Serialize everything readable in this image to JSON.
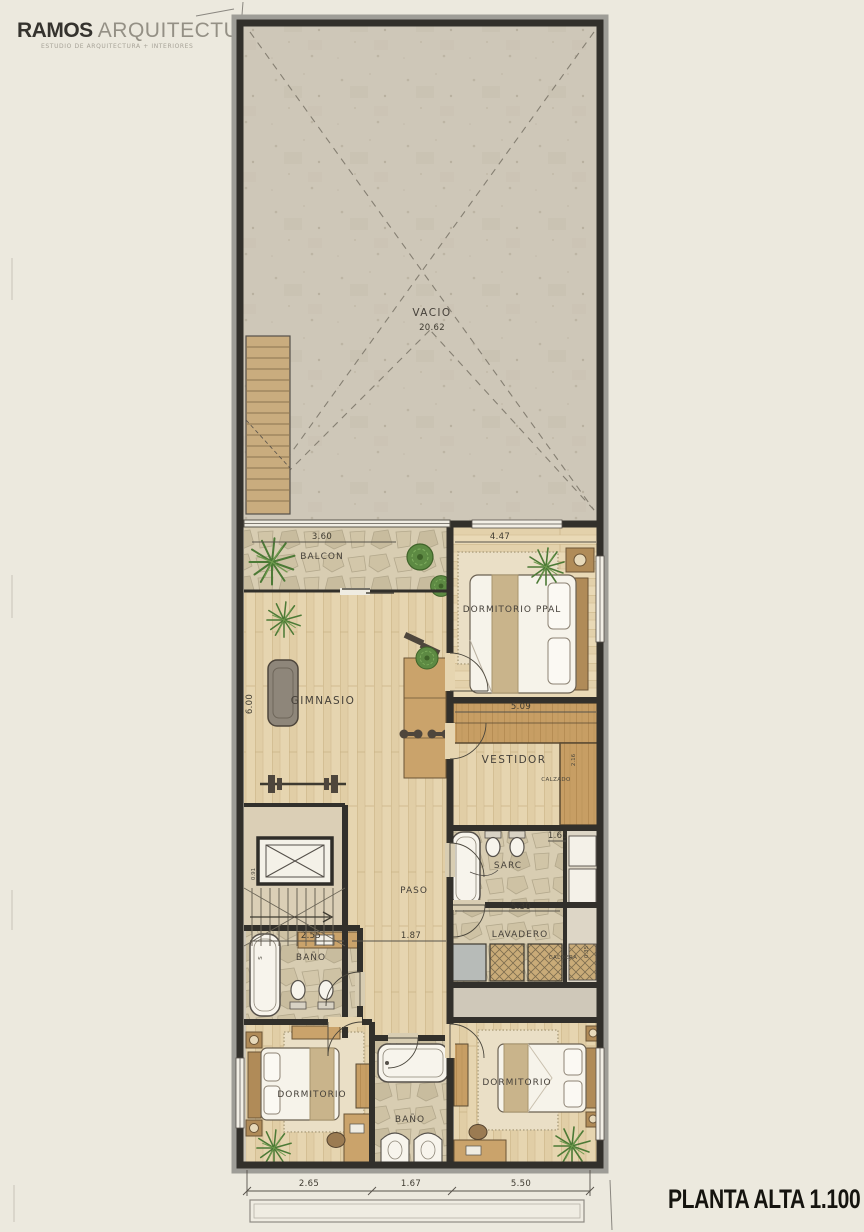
{
  "brand": {
    "bold": "RAMOS",
    "light": "ARQUITECTURA",
    "tagline": "ESTUDIO DE ARQUITECTURA + INTERIORES"
  },
  "title": "PLANTA ALTA 1.100",
  "palette": {
    "paper": "#ece9de",
    "wall": "#32302b",
    "wood": "#e6d5b0",
    "stone": "#d8cdb2",
    "plant": "#5d8a43"
  },
  "plan": {
    "vacio": {
      "label": "VACIO",
      "value": "20.62"
    },
    "balcon": {
      "label": "BALCON",
      "dim": "3.60"
    },
    "dorm_ppal": {
      "label": "DORMITORIO PPAL",
      "dim": "4.47"
    },
    "gimnasio": {
      "label": "GIMNASIO",
      "dim": "6.00"
    },
    "vestidor": {
      "label": "VESTIDOR",
      "dim_top": "5.09",
      "dim_side": "2.16",
      "note": "CALZADO"
    },
    "sarc": {
      "label": "SARC",
      "dim": "1.65"
    },
    "paso": {
      "label": "PASO",
      "dim": "1.87"
    },
    "stairs": {
      "dim": "0.91"
    },
    "lavadero": {
      "label": "LAVADERO",
      "dim": "5.30",
      "note": "CALDERA",
      "dim_side": "0.35"
    },
    "bano_izq": {
      "label": "BAÑO",
      "dim": "2.55",
      "tub_mark": "S"
    },
    "dorm_izq": {
      "label": "DORMITORIO"
    },
    "bano_centro": {
      "label": "BAÑO"
    },
    "dorm_der": {
      "label": "DORMITORIO"
    },
    "bottom_dims": [
      "2.65",
      "1.67",
      "5.50"
    ]
  }
}
